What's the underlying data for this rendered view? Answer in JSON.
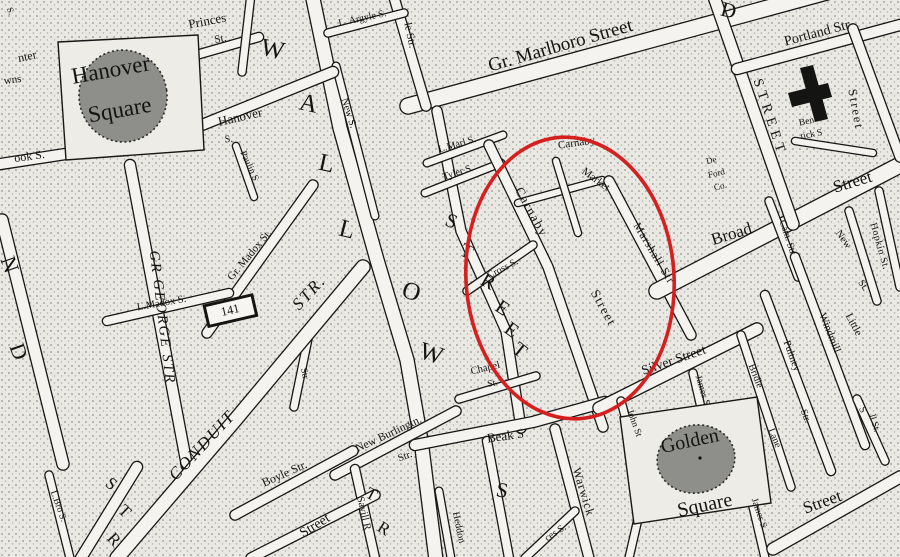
{
  "map": {
    "kind": "engraved street map with red highlight annotation",
    "palette": {
      "paper": "#e9e8e3",
      "ink": "#141412",
      "street_fill": "#f4f3ef",
      "stipple_dot": "#6e6e6a",
      "square_blob": "#8e8e8b",
      "plaza": "#edece7",
      "highlight_red": "#d61f1f"
    },
    "annotation": {
      "shape": "ellipse",
      "cx": 570,
      "cy": 278,
      "rx": 104,
      "ry": 141,
      "rotate": -4,
      "color": "#d61f1f",
      "stroke_width": 3.6
    },
    "labels": [
      {
        "t": "S.",
        "x": 8,
        "y": 12,
        "r": 70,
        "s": 9
      },
      {
        "t": "nter",
        "x": 28,
        "y": 60,
        "r": -12,
        "s": 12
      },
      {
        "t": "wns",
        "x": 13,
        "y": 83,
        "r": -8,
        "s": 11
      },
      {
        "t": "Hanover",
        "x": 112,
        "y": 77,
        "r": -10,
        "s": 23
      },
      {
        "t": "Square",
        "x": 121,
        "y": 117,
        "r": -10,
        "s": 23
      },
      {
        "t": "Princes",
        "x": 208,
        "y": 25,
        "r": -11,
        "s": 13
      },
      {
        "t": "St.",
        "x": 221,
        "y": 42,
        "r": -11,
        "s": 11
      },
      {
        "t": "Hanover",
        "x": 241,
        "y": 121,
        "r": -13,
        "s": 13
      },
      {
        "t": "S.",
        "x": 229,
        "y": 142,
        "r": -5,
        "s": 10
      },
      {
        "t": "ook S.",
        "x": 30,
        "y": 160,
        "r": -8,
        "s": 12
      },
      {
        "t": "Paulin S",
        "x": 247,
        "y": 167,
        "r": 65,
        "s": 9.5
      },
      {
        "t": "W",
        "x": 271,
        "y": 57,
        "r": 12,
        "s": 25
      },
      {
        "t": "A",
        "x": 307,
        "y": 111,
        "r": 12,
        "s": 25
      },
      {
        "t": "L",
        "x": 325,
        "y": 171,
        "r": 12,
        "s": 25
      },
      {
        "t": "L",
        "x": 345,
        "y": 237,
        "r": 14,
        "s": 25
      },
      {
        "t": "O",
        "x": 409,
        "y": 299,
        "r": 18,
        "s": 25
      },
      {
        "t": "W",
        "x": 429,
        "y": 361,
        "r": 18,
        "s": 25
      },
      {
        "t": "L. Argyle S.",
        "x": 363,
        "y": 21,
        "r": -12,
        "s": 10
      },
      {
        "t": "le Str.",
        "x": 407,
        "y": 36,
        "r": 78,
        "s": 11
      },
      {
        "t": "New S.",
        "x": 346,
        "y": 114,
        "r": 72,
        "s": 10.5
      },
      {
        "t": "Gr. Marlboro Street",
        "x": 562,
        "y": 51,
        "r": -16,
        "s": 19
      },
      {
        "t": "D",
        "x": 727,
        "y": 17,
        "r": 14,
        "s": 21
      },
      {
        "t": "STREET",
        "x": 766,
        "y": 119,
        "r": 72,
        "s": 14,
        "ls": 5
      },
      {
        "t": "Portland Str",
        "x": 818,
        "y": 37,
        "r": -15,
        "s": 14
      },
      {
        "t": "Street",
        "x": 852,
        "y": 110,
        "r": 80,
        "s": 12.5,
        "ls": 2
      },
      {
        "t": "Ben",
        "x": 807,
        "y": 124,
        "r": -12,
        "s": 9.5
      },
      {
        "t": "tick S",
        "x": 812,
        "y": 137,
        "r": -12,
        "s": 9.5
      },
      {
        "t": "De",
        "x": 712,
        "y": 163,
        "r": -14,
        "s": 9
      },
      {
        "t": "Ford",
        "x": 717,
        "y": 176,
        "r": -14,
        "s": 9
      },
      {
        "t": "Co.",
        "x": 721,
        "y": 189,
        "r": -14,
        "s": 9
      },
      {
        "t": "L.Marl S.",
        "x": 458,
        "y": 147,
        "r": -16,
        "s": 10
      },
      {
        "t": "Tyler S.",
        "x": 459,
        "y": 175,
        "r": -18,
        "s": 10
      },
      {
        "t": "Carnaby",
        "x": 577,
        "y": 146,
        "r": -8,
        "s": 11
      },
      {
        "t": "Market",
        "x": 594,
        "y": 182,
        "r": 36,
        "s": 11
      },
      {
        "t": "Carnaby",
        "x": 528,
        "y": 214,
        "r": 61,
        "s": 13,
        "ls": 1.5
      },
      {
        "t": "Street",
        "x": 600,
        "y": 310,
        "r": 61,
        "s": 13,
        "ls": 1.5
      },
      {
        "t": "Marshall Str",
        "x": 651,
        "y": 255,
        "r": 59,
        "s": 11.5,
        "ls": 1
      },
      {
        "t": "Cross S.",
        "x": 504,
        "y": 271,
        "r": -27,
        "s": 10
      },
      {
        "t": "S",
        "x": 449,
        "y": 227,
        "r": 22,
        "s": 20
      },
      {
        "t": "T",
        "x": 464,
        "y": 257,
        "r": 26,
        "s": 20
      },
      {
        "t": "R",
        "x": 485,
        "y": 287,
        "r": 30,
        "s": 20
      },
      {
        "t": "E",
        "x": 499,
        "y": 313,
        "r": 34,
        "s": 20
      },
      {
        "t": "E",
        "x": 508,
        "y": 335,
        "r": 36,
        "s": 20
      },
      {
        "t": "T",
        "x": 516,
        "y": 355,
        "r": 38,
        "s": 20
      },
      {
        "t": "Chapel",
        "x": 486,
        "y": 371,
        "r": -13,
        "s": 10.5
      },
      {
        "t": "St.",
        "x": 493,
        "y": 386,
        "r": -10,
        "s": 9.5
      },
      {
        "t": "Beak S",
        "x": 506,
        "y": 440,
        "r": -8,
        "s": 13
      },
      {
        "t": "Warwick",
        "x": 580,
        "y": 493,
        "r": 73,
        "s": 12,
        "ls": 1
      },
      {
        "t": "S",
        "x": 501,
        "y": 497,
        "r": 10,
        "s": 21
      },
      {
        "t": "Heddon",
        "x": 456,
        "y": 528,
        "r": 78,
        "s": 10
      },
      {
        "t": "ces S.",
        "x": 557,
        "y": 535,
        "r": -33,
        "s": 10
      },
      {
        "t": "T",
        "x": 369,
        "y": 499,
        "r": 28,
        "s": 17
      },
      {
        "t": "R",
        "x": 381,
        "y": 533,
        "r": 32,
        "s": 17
      },
      {
        "t": "Street",
        "x": 317,
        "y": 529,
        "r": -32,
        "s": 14
      },
      {
        "t": "Savill R",
        "x": 361,
        "y": 514,
        "r": 77,
        "s": 10.5
      },
      {
        "t": "Boyle Str.",
        "x": 286,
        "y": 477,
        "r": -24,
        "s": 12
      },
      {
        "t": "New Burlingtn.",
        "x": 390,
        "y": 437,
        "r": -25,
        "s": 11.5
      },
      {
        "t": "Str.",
        "x": 406,
        "y": 459,
        "r": -20,
        "s": 10.5
      },
      {
        "t": "CONDUIT",
        "x": 206,
        "y": 449,
        "r": -47,
        "s": 17,
        "it": 1,
        "ls": 2
      },
      {
        "t": "STR.",
        "x": 313,
        "y": 296,
        "r": -47,
        "s": 17,
        "it": 1,
        "ls": 2
      },
      {
        "t": "GR GEORGE STR",
        "x": 158,
        "y": 318,
        "r": 83,
        "s": 14.5,
        "it": 1,
        "ls": 2
      },
      {
        "t": "Gr. Madox St.",
        "x": 252,
        "y": 257,
        "r": -50,
        "s": 11
      },
      {
        "t": "L.Madox S.",
        "x": 162,
        "y": 306,
        "r": -10,
        "s": 10.5
      },
      {
        "t": "Str",
        "x": 302,
        "y": 374,
        "r": 78,
        "s": 9.5
      },
      {
        "t": "N",
        "x": 3,
        "y": 267,
        "r": 70,
        "s": 22
      },
      {
        "t": "D",
        "x": 12,
        "y": 354,
        "r": 70,
        "s": 22
      },
      {
        "t": "L.Bro S.",
        "x": 56,
        "y": 507,
        "r": 70,
        "s": 9.5
      },
      {
        "t": "S",
        "x": 108,
        "y": 488,
        "r": 38,
        "s": 17
      },
      {
        "t": "T",
        "x": 121,
        "y": 515,
        "r": 44,
        "s": 17
      },
      {
        "t": "R",
        "x": 110,
        "y": 543,
        "r": 48,
        "s": 17
      },
      {
        "t": "141",
        "x": 231,
        "y": 314,
        "r": -13,
        "s": 12.5
      },
      {
        "t": "Broad",
        "x": 733,
        "y": 239,
        "r": -17,
        "s": 17
      },
      {
        "t": "Street",
        "x": 854,
        "y": 187,
        "r": -17,
        "s": 17
      },
      {
        "t": "Silver Street",
        "x": 675,
        "y": 364,
        "r": -19,
        "s": 13.5
      },
      {
        "t": "Golden",
        "x": 691,
        "y": 447,
        "r": -12,
        "s": 20
      },
      {
        "t": "Square",
        "x": 706,
        "y": 511,
        "r": -12,
        "s": 20
      },
      {
        "t": "John St",
        "x": 632,
        "y": 424,
        "r": 70,
        "s": 9.5
      },
      {
        "t": "James S",
        "x": 700,
        "y": 391,
        "r": 73,
        "s": 9.5
      },
      {
        "t": "James S.",
        "x": 757,
        "y": 515,
        "r": 71,
        "s": 9.5
      },
      {
        "t": "Bridle",
        "x": 753,
        "y": 377,
        "r": 68,
        "s": 10
      },
      {
        "t": "Lane",
        "x": 772,
        "y": 439,
        "r": 68,
        "s": 10
      },
      {
        "t": "Pultney",
        "x": 789,
        "y": 357,
        "r": 70,
        "s": 10.5
      },
      {
        "t": "Str.",
        "x": 803,
        "y": 417,
        "r": 70,
        "s": 10
      },
      {
        "t": "Little",
        "x": 851,
        "y": 326,
        "r": 62,
        "s": 11
      },
      {
        "t": "Windmill",
        "x": 827,
        "y": 334,
        "r": 68,
        "s": 11
      },
      {
        "t": "S",
        "x": 860,
        "y": 411,
        "r": 65,
        "s": 10
      },
      {
        "t": "New",
        "x": 841,
        "y": 241,
        "r": 55,
        "s": 10.5
      },
      {
        "t": "St.",
        "x": 861,
        "y": 287,
        "r": 55,
        "s": 10
      },
      {
        "t": "Hopkin St.",
        "x": 877,
        "y": 247,
        "r": 74,
        "s": 10,
        "ls": 0.5
      },
      {
        "t": "Cam. Str",
        "x": 785,
        "y": 238,
        "r": 72,
        "s": 10
      },
      {
        "t": "Street",
        "x": 824,
        "y": 507,
        "r": -20,
        "s": 17
      },
      {
        "t": "ll St.",
        "x": 872,
        "y": 424,
        "r": 72,
        "s": 9.5
      }
    ]
  }
}
